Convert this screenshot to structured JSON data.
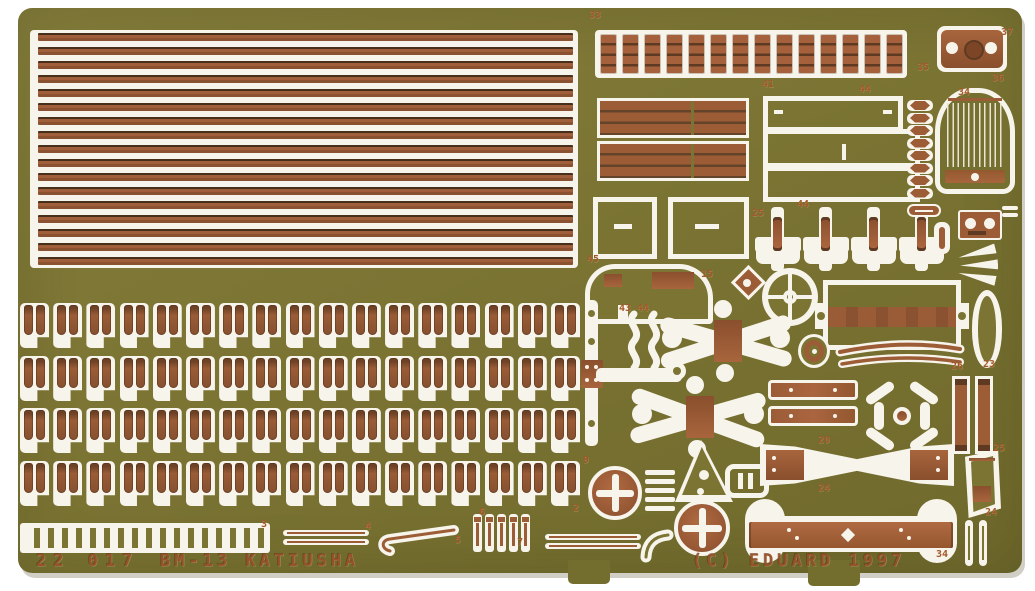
{
  "image": {
    "kind": "scanned photograph of a photo-etched brass detail fret for a scale model kit",
    "width": 1035,
    "height": 591
  },
  "fret": {
    "footer": {
      "set_number": "22 017",
      "set_name": "BM-13 KATIUSHA",
      "copyright": "(C) EDUARD 1997"
    },
    "colors": {
      "brass_green": "#7b7433",
      "copper": "#9c5c36",
      "etched_white": "#f7f4eb",
      "number_copper": "#a2582a",
      "background": "#ffffff"
    },
    "counts": {
      "launch_rails": 17,
      "clip_rows": 4,
      "clips_per_row": 17,
      "tread_rungs": 14,
      "radiator_beads": 8,
      "pins": 5,
      "stack_bars": 5,
      "mushroom_brackets": 4
    },
    "part_numbers": [
      {
        "text": "33",
        "x": 589,
        "y": 10
      },
      {
        "text": "37",
        "x": 1001,
        "y": 27
      },
      {
        "text": "35",
        "x": 917,
        "y": 62
      },
      {
        "text": "36",
        "x": 992,
        "y": 73
      },
      {
        "text": "41",
        "x": 762,
        "y": 79
      },
      {
        "text": "44",
        "x": 859,
        "y": 84
      },
      {
        "text": "34",
        "x": 958,
        "y": 87
      },
      {
        "text": "44",
        "x": 797,
        "y": 199
      },
      {
        "text": "25",
        "x": 752,
        "y": 208
      },
      {
        "text": "45",
        "x": 587,
        "y": 254
      },
      {
        "text": "15",
        "x": 701,
        "y": 269
      },
      {
        "text": "43",
        "x": 619,
        "y": 303
      },
      {
        "text": "44",
        "x": 637,
        "y": 303
      },
      {
        "text": "26",
        "x": 951,
        "y": 361
      },
      {
        "text": "23",
        "x": 983,
        "y": 359
      },
      {
        "text": "20",
        "x": 818,
        "y": 435
      },
      {
        "text": "25",
        "x": 993,
        "y": 443
      },
      {
        "text": "24",
        "x": 818,
        "y": 483
      },
      {
        "text": "24",
        "x": 985,
        "y": 507
      },
      {
        "text": "9",
        "x": 583,
        "y": 455
      },
      {
        "text": "2",
        "x": 573,
        "y": 503
      },
      {
        "text": "3",
        "x": 261,
        "y": 519
      },
      {
        "text": "4",
        "x": 365,
        "y": 521
      },
      {
        "text": "6",
        "x": 479,
        "y": 507
      },
      {
        "text": "5",
        "x": 455,
        "y": 535
      },
      {
        "text": "7",
        "x": 517,
        "y": 537
      },
      {
        "text": "34",
        "x": 936,
        "y": 549
      }
    ]
  }
}
